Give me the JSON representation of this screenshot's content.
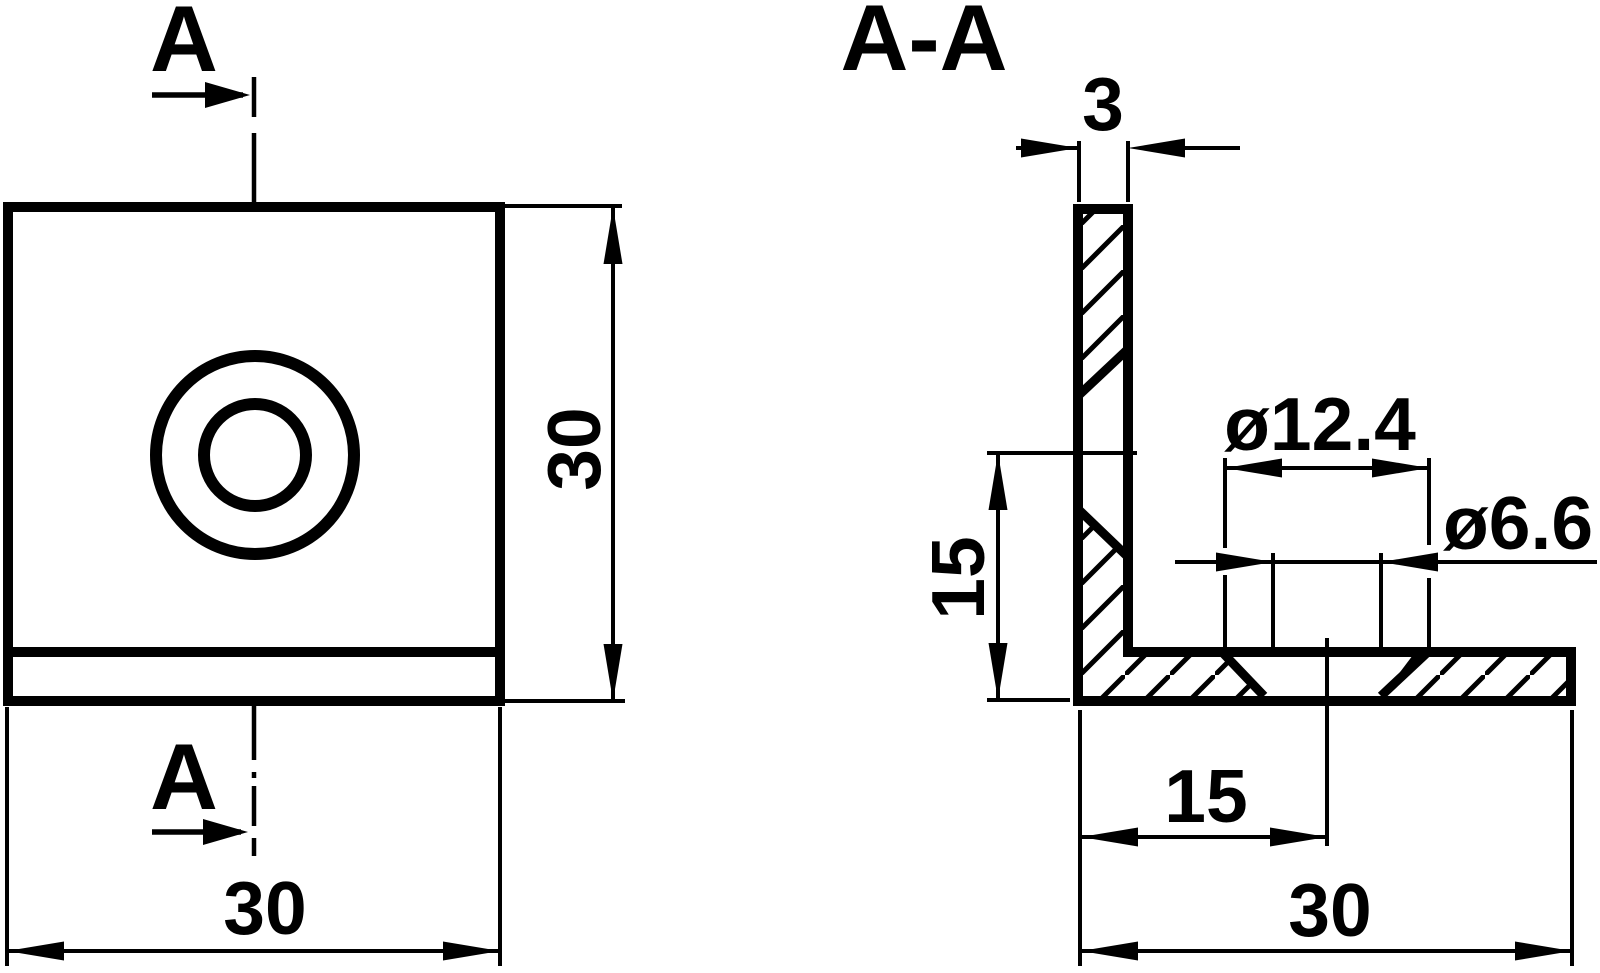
{
  "page": {
    "background": "#ffffff"
  },
  "drawing": {
    "ink": "#000000",
    "type": "technical-drawing",
    "front_view": {
      "section_label_top": "A",
      "section_label_bottom": "A",
      "dim_height": "30",
      "dim_width": "30"
    },
    "section_view": {
      "title": "A-A",
      "dim_thickness": "3",
      "dim_counterbore": "ø12.4",
      "dim_hole": "ø6.6",
      "dim_hole_height": "15",
      "dim_hole_offset": "15",
      "dim_leg_length": "30"
    }
  }
}
